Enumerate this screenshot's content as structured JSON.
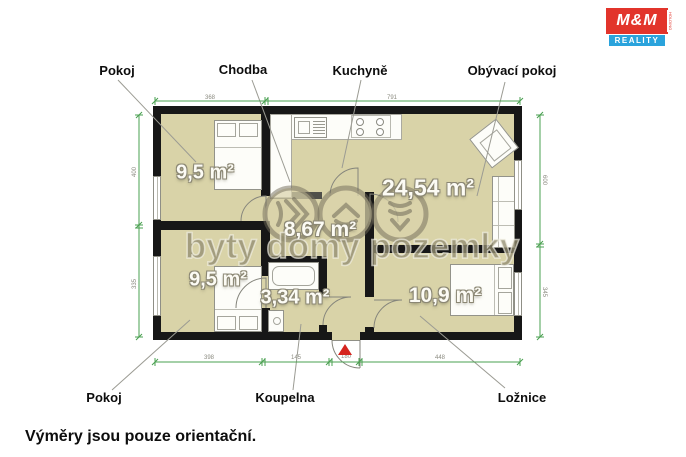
{
  "logo": {
    "mm": "M&M",
    "reality": "REALITY",
    "holding": "HOLDING"
  },
  "footer_note": "Výměry jsou pouze orientační.",
  "watermark_text": "byty domy pozemky",
  "labels": {
    "top": [
      "Pokoj",
      "Chodba",
      "Kuchyně",
      "Obývací pokoj"
    ],
    "bottom": [
      "Pokoj",
      "Koupelna",
      "Ložnice"
    ]
  },
  "rooms": {
    "pokoj_top": "9,5 m²",
    "chodba": "8,67 m²",
    "obyvaci_pokoj": "24,54 m²",
    "pokoj_bottom": "9,5 m²",
    "koupelna": "3,34 m²",
    "loznice": "10,9 m²"
  },
  "dimensions": {
    "top": [
      "368",
      "791"
    ],
    "left": [
      "400",
      "335"
    ],
    "right": [
      "600",
      "345"
    ],
    "bottom": [
      "398",
      "145",
      "180",
      "448"
    ]
  },
  "colors": {
    "room_fill": "#d9d3a8",
    "wall": "#171717",
    "dimension_green": "#4aa050",
    "entry_red": "#d5241e",
    "logo_red": "#e2342b",
    "logo_blue": "#2aa3dc"
  }
}
